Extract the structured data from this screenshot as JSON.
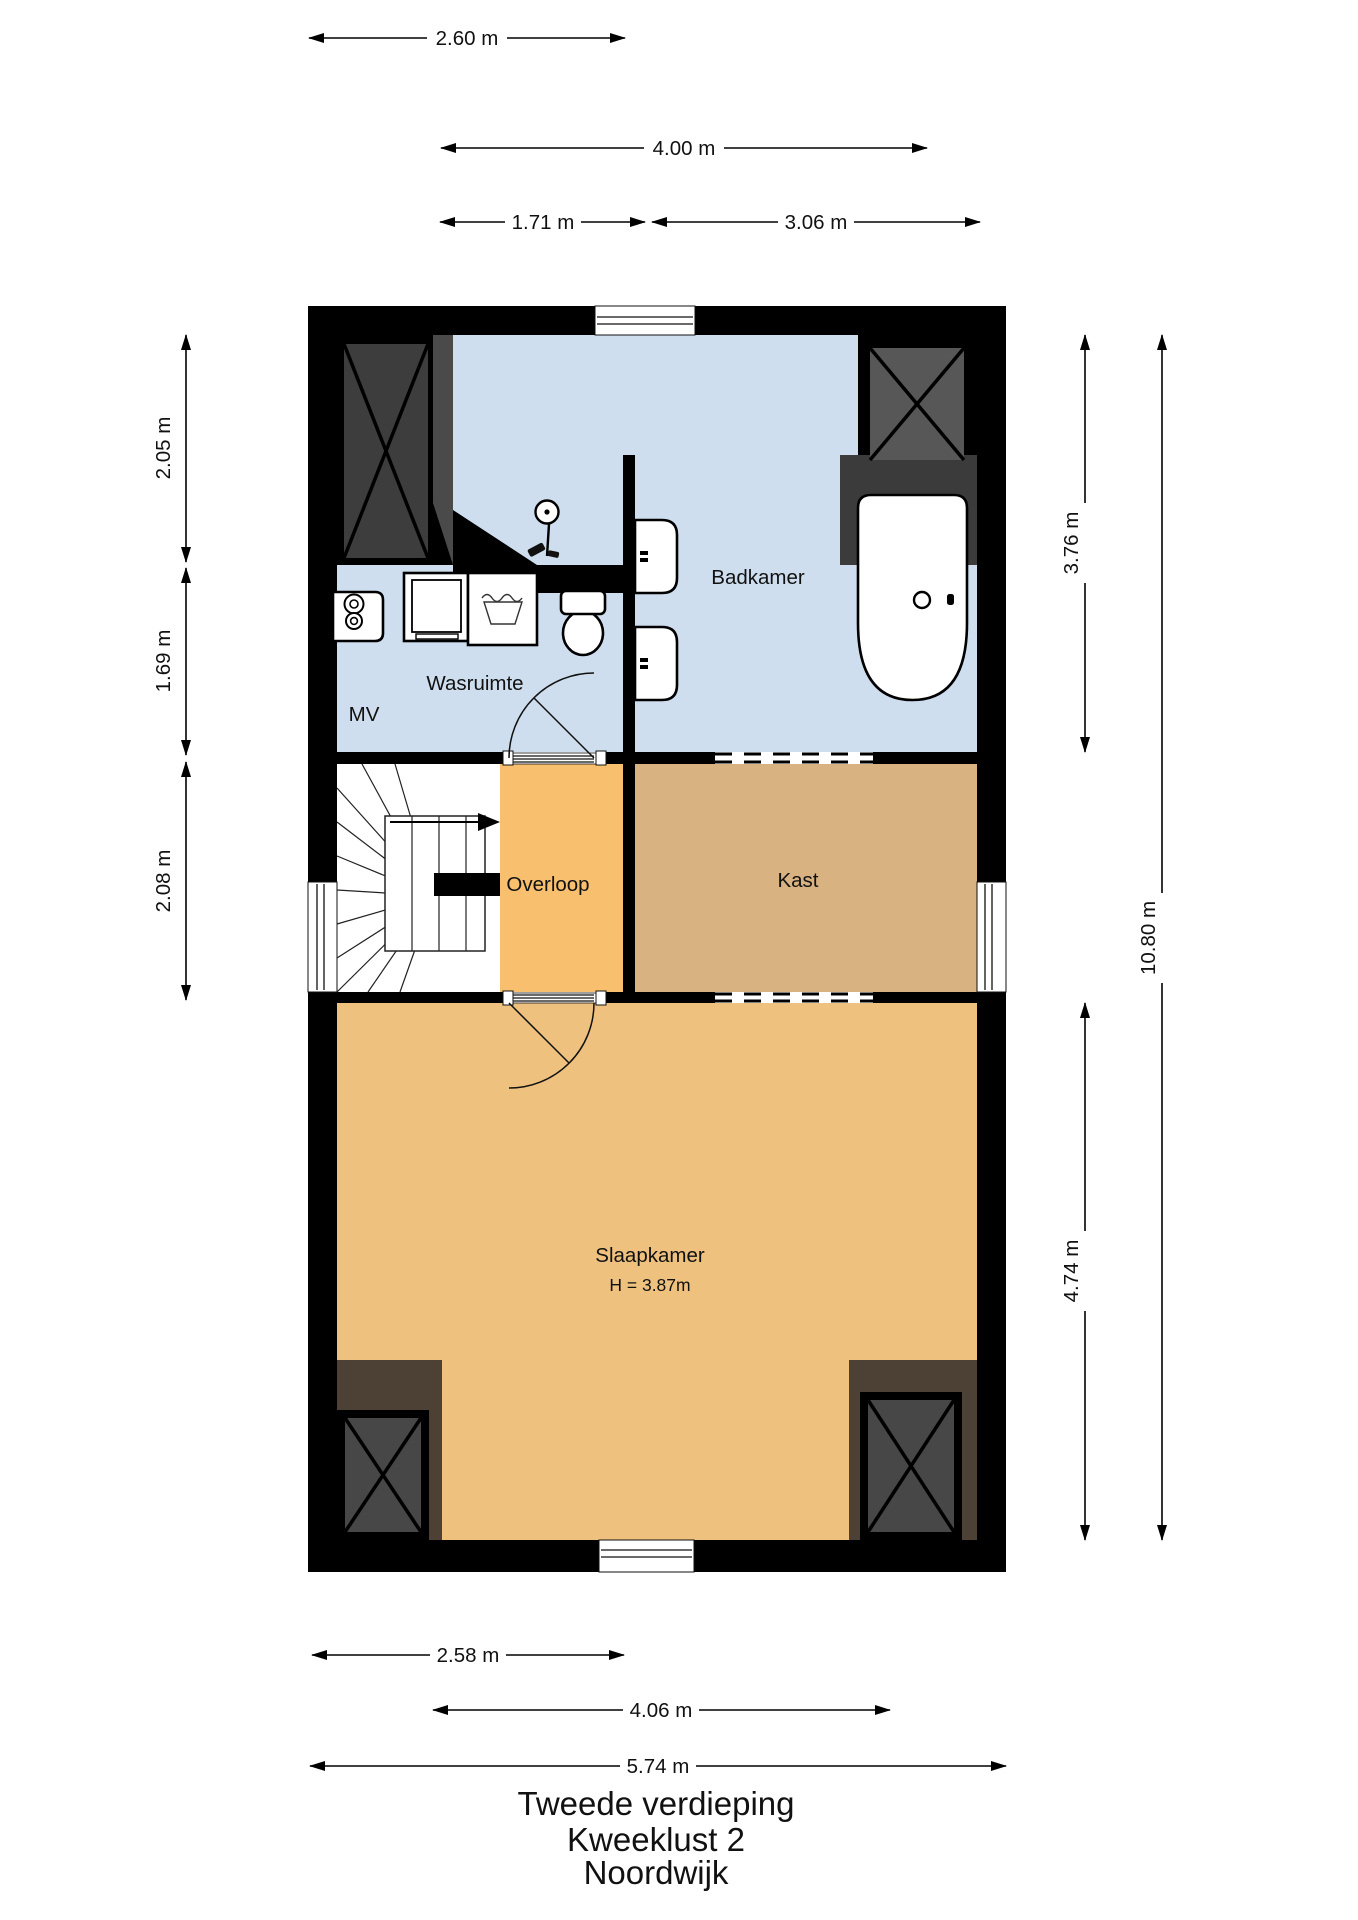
{
  "title_block": {
    "line1": "Tweede verdieping",
    "line2": "Kweeklust 2",
    "line3": "Noordwijk"
  },
  "rooms": {
    "badkamer": {
      "label": "Badkamer"
    },
    "wasruimte": {
      "label": "Wasruimte"
    },
    "mv": {
      "label": "MV"
    },
    "overloop": {
      "label": "Overloop"
    },
    "kast": {
      "label": "Kast"
    },
    "slaapkamer": {
      "label": "Slaapkamer",
      "height_note": "H = 3.87m"
    }
  },
  "dimensions": {
    "top": [
      {
        "label": "2.60 m"
      },
      {
        "label": "4.00 m"
      },
      {
        "label": "1.71 m"
      },
      {
        "label": "3.06 m"
      }
    ],
    "left": [
      {
        "label": "2.05 m"
      },
      {
        "label": "1.69 m"
      },
      {
        "label": "2.08 m"
      }
    ],
    "right": [
      {
        "label": "3.76 m"
      },
      {
        "label": "4.74 m"
      },
      {
        "label": "10.80 m"
      }
    ],
    "bottom": [
      {
        "label": "2.58 m"
      },
      {
        "label": "4.06 m"
      },
      {
        "label": "5.74 m"
      }
    ]
  },
  "colors": {
    "wall": "#000000",
    "badkamer_floor": "#cfdeee",
    "overloop_floor": "#f7bf6e",
    "kast_floor": "#d9b282",
    "slaapkamer_floor": "#eec17e",
    "stairs_floor": "#ffffff",
    "chimney_box_dark": "#3d3d3d",
    "chimney_box_light": "#575757",
    "chimney_box_bottom": "#474747",
    "chimney_wedge": "#4a4a4a",
    "chimney_brown": "#4d4136",
    "tub_deck": "#3b3b3b"
  }
}
